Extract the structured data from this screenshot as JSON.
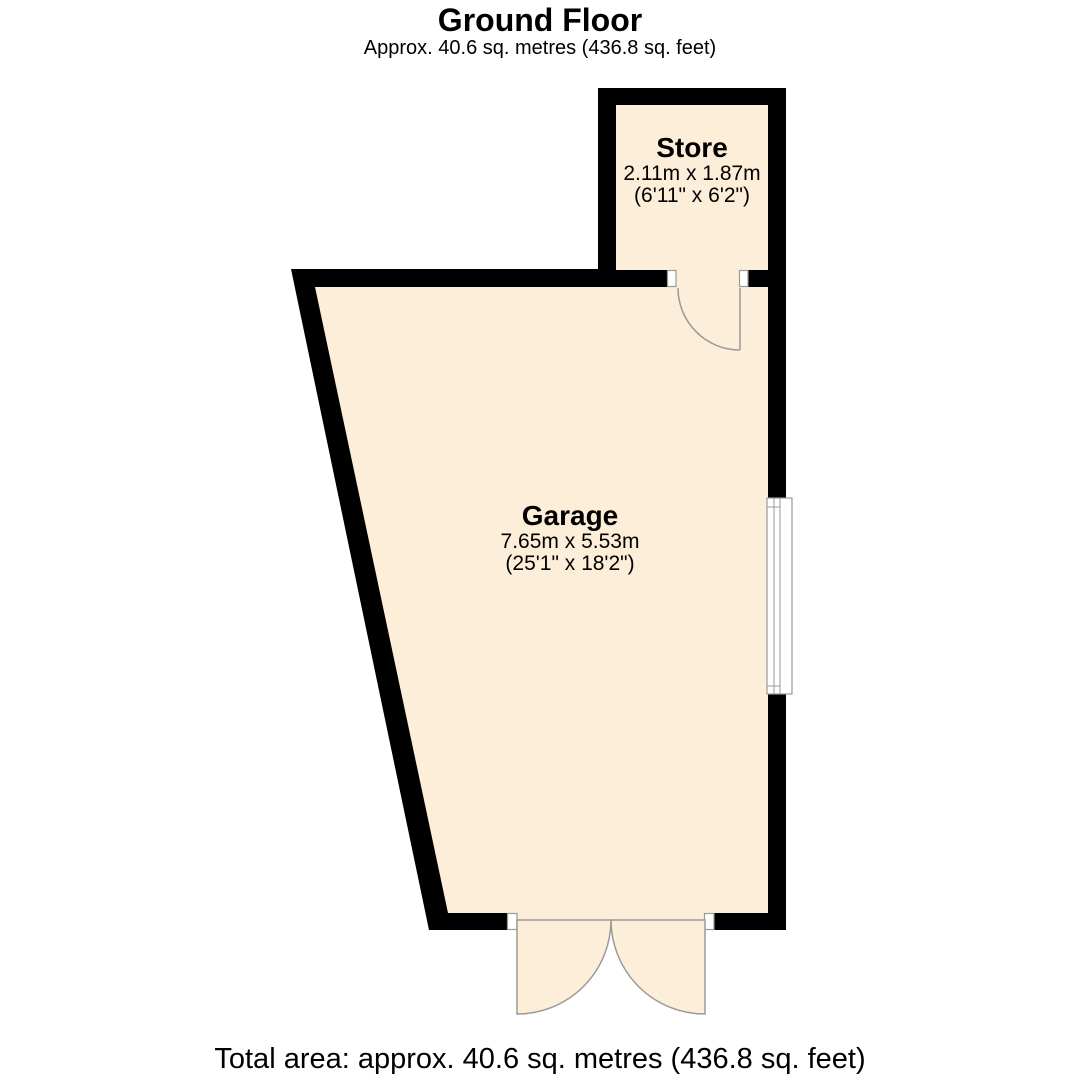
{
  "header": {
    "title": "Ground Floor",
    "subtitle": "Approx. 40.6 sq. metres (436.8 sq. feet)"
  },
  "rooms": [
    {
      "name": "Store",
      "dimensions_metric": "2.11m x 1.87m",
      "dimensions_imperial": "(6'11\" x 6'2\")"
    },
    {
      "name": "Garage",
      "dimensions_metric": "7.65m x 5.53m",
      "dimensions_imperial": "(25'1\" x 18'2\")"
    }
  ],
  "footer": {
    "total_area": "Total area: approx. 40.6 sq. metres (436.8 sq. feet)"
  },
  "colors": {
    "background": "#ffffff",
    "wall": "#000000",
    "floor_fill": "#FCEED8",
    "fixture_outline": "#9a9a96",
    "text": "#000000"
  }
}
